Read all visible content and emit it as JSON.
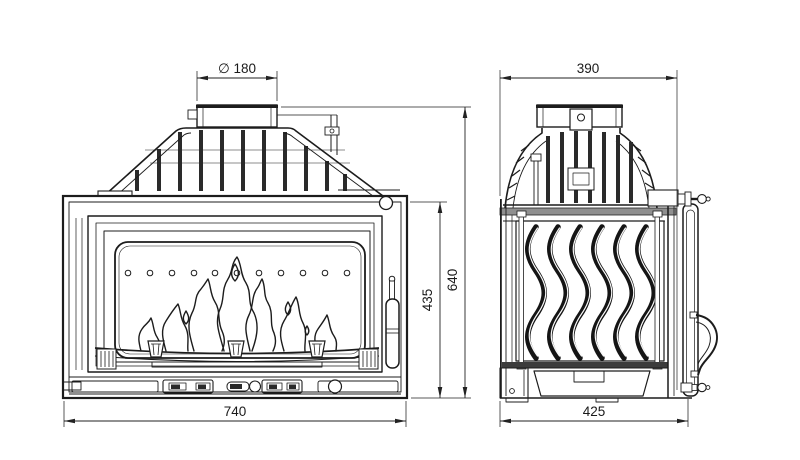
{
  "drawing": {
    "type": "technical-orthographic-drawing",
    "subject": "fireplace-insert",
    "background_color": "#ffffff",
    "line_color": "#1c1c1c",
    "dimension_color": "#222222",
    "views": {
      "front_view": "front elevation with flue collar, finned heat exchanger, glass door with flames, control bar",
      "side_view": "side elevation with domed finned top, wavy cast side panel, door edge with handle"
    },
    "dimensions": {
      "flue_diameter": "∅ 180",
      "side_top_width": "390",
      "overall_height": "640",
      "firebox_height": "435",
      "front_width": "740",
      "side_bottom_depth": "425"
    }
  }
}
